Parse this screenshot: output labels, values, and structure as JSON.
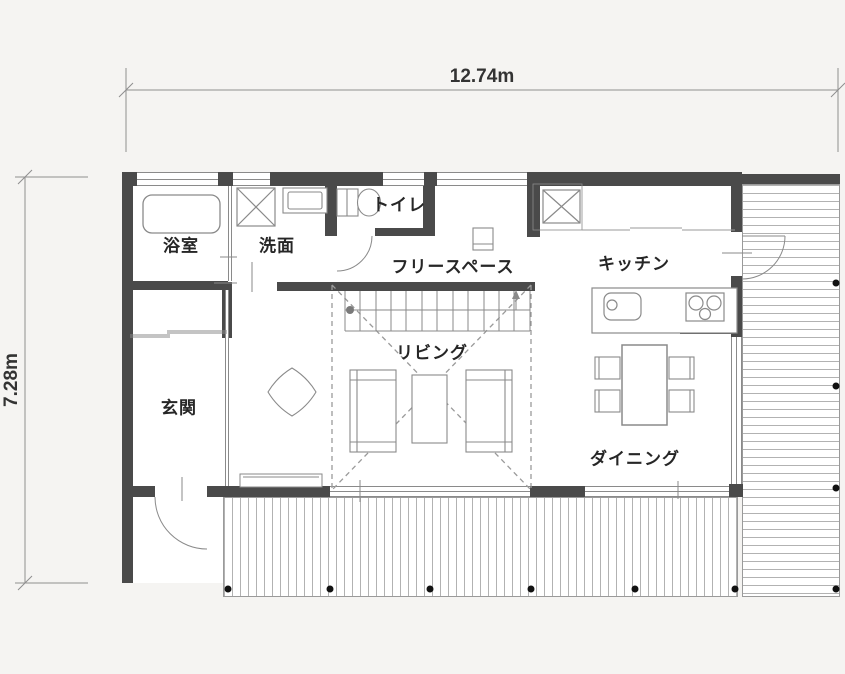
{
  "dimensions": {
    "width": "12.74m",
    "height": "7.28m"
  },
  "rooms": [
    {
      "id": "bathroom",
      "label": "浴室"
    },
    {
      "id": "washroom",
      "label": "洗面"
    },
    {
      "id": "toilet",
      "label": "トイレ"
    },
    {
      "id": "free_space",
      "label": "フリースペース"
    },
    {
      "id": "kitchen",
      "label": "キッチン"
    },
    {
      "id": "entrance",
      "label": "玄関"
    },
    {
      "id": "living",
      "label": "リビング"
    },
    {
      "id": "dining",
      "label": "ダイニング"
    }
  ],
  "fixtures": [
    "bathtub",
    "washing-machine",
    "washbasin",
    "toilet-fixture",
    "refrigerator",
    "kitchen-counter",
    "kitchen-sink",
    "cooktop",
    "dining-table",
    "dining-chairs",
    "sofas",
    "coffee-table",
    "tv-board",
    "lounge-chair",
    "staircase",
    "void-dashed-lines",
    "wood-deck-bottom",
    "wood-deck-right",
    "deck-posts",
    "entrance-door",
    "toilet-door",
    "deck-door"
  ],
  "colors": {
    "background": "#f5f4f2",
    "floor": "#ffffff",
    "wall": "#4a4a4a",
    "line": "#8a8a8a",
    "dash": "#9a9a9a",
    "text": "#262626",
    "post": "#111111"
  }
}
